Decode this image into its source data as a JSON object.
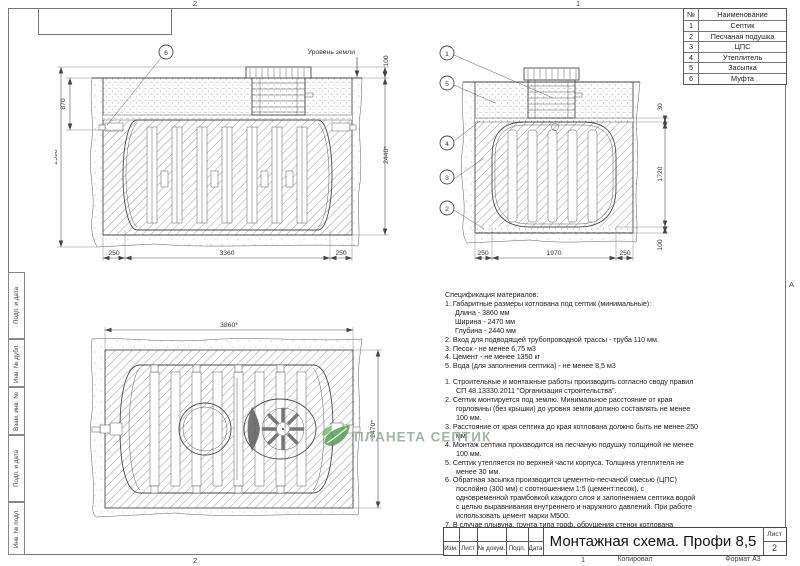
{
  "frame": {
    "zones": {
      "top_left": "2",
      "top_right": "1",
      "bottom_left": "2",
      "bottom_right": "1",
      "right_letter": "А"
    },
    "stamps": [
      "Подп. и дата",
      "Инв. № дубл.",
      "Взам. инв. №",
      "Подп. и дата",
      "Инв. № подл."
    ]
  },
  "parts_table": {
    "col_num": "№",
    "col_name": "Наименование",
    "rows": [
      {
        "num": "1",
        "name": "Септик"
      },
      {
        "num": "2",
        "name": "Песчаная подушка"
      },
      {
        "num": "3",
        "name": "ЦПС"
      },
      {
        "num": "4",
        "name": "Утеплитель"
      },
      {
        "num": "5",
        "name": "Засыпка"
      },
      {
        "num": "6",
        "name": "Муфта"
      }
    ]
  },
  "views": {
    "side": {
      "ground_label": "Уровень земли",
      "balloon": "6",
      "dim_870": "870",
      "dim_2590": "2590",
      "dim_100": "100",
      "dim_2440": "2440*",
      "dim_250_left": "250",
      "dim_3360": "3360",
      "dim_250_right": "250"
    },
    "front": {
      "balloons": [
        "1",
        "5",
        "4",
        "3",
        "2"
      ],
      "dim_30": "30",
      "dim_1720": "1720",
      "dim_100": "100",
      "dim_250_left": "250",
      "dim_1970": "1970",
      "dim_250_right": "250"
    },
    "top": {
      "dim_3860": "3860*",
      "dim_2470": "2470*"
    }
  },
  "spec": {
    "title": "Спецификация материалов:",
    "lines": [
      "1. Габаритные размеры котлована под септик (минимальные):",
      "Длина - 3860 мм",
      "Ширина - 2470 мм",
      "Глубина - 2440 мм",
      "2. Вход для подводящей трубопроводной трассы - труба 110 мм.",
      "3. Песок - не менее 6,75 м3",
      "4. Цемент - не менее 1350 кг",
      "5. Вода (для заполнения септика) - не менее 8,5 м3"
    ],
    "notes": [
      "1. Строительные и монтажные работы производить согласно своду правил СП 48.13330.2011 \"Организация строительства\".",
      "2. Септик монтируется под землю. Минимальное расстояние от края горловины (без крышки) до уровня земли должно составлять не менее 100 мм.",
      "3. Расстояние от края септика до края котлована должно быть не менее 250 мм.",
      "4. Монтаж септика производится на песчаную подушку толщиной не менее 100 мм.",
      "5. Септик утепляется по верхней части корпуса. Толщина утеплителя не менее 30 мм.",
      "6. Обратная засыпка производится цементно-песчаной смесью (ЦПС) послойно (300 мм) с соотношением 1:5 (цемент:песок), с одновременной трамбовкой каждого слоя и заполнением септика водой с целью выравнивания внутреннего и наружного давлений. При работе использовать цемент марки М500.",
      "7. В случае плывуна, грунта типа торф, обрушения стенок котлована необходим монтаж опалубки из досок сечением 150x50 мм."
    ]
  },
  "watermark": {
    "text": "ПЛАНЕТА СЕПТИК",
    "color": "#8fa692",
    "leaf_color": "#54a054"
  },
  "title_block": {
    "cols": [
      "Изм.",
      "Лист",
      "№ докум.",
      "Подп.",
      "Дата"
    ],
    "title": "Монтажная схема. Профи 8,5",
    "sheet_label": "Лист",
    "sheet_value": "2",
    "footer_copy": "Копировал",
    "footer_format": "Формат А3"
  }
}
